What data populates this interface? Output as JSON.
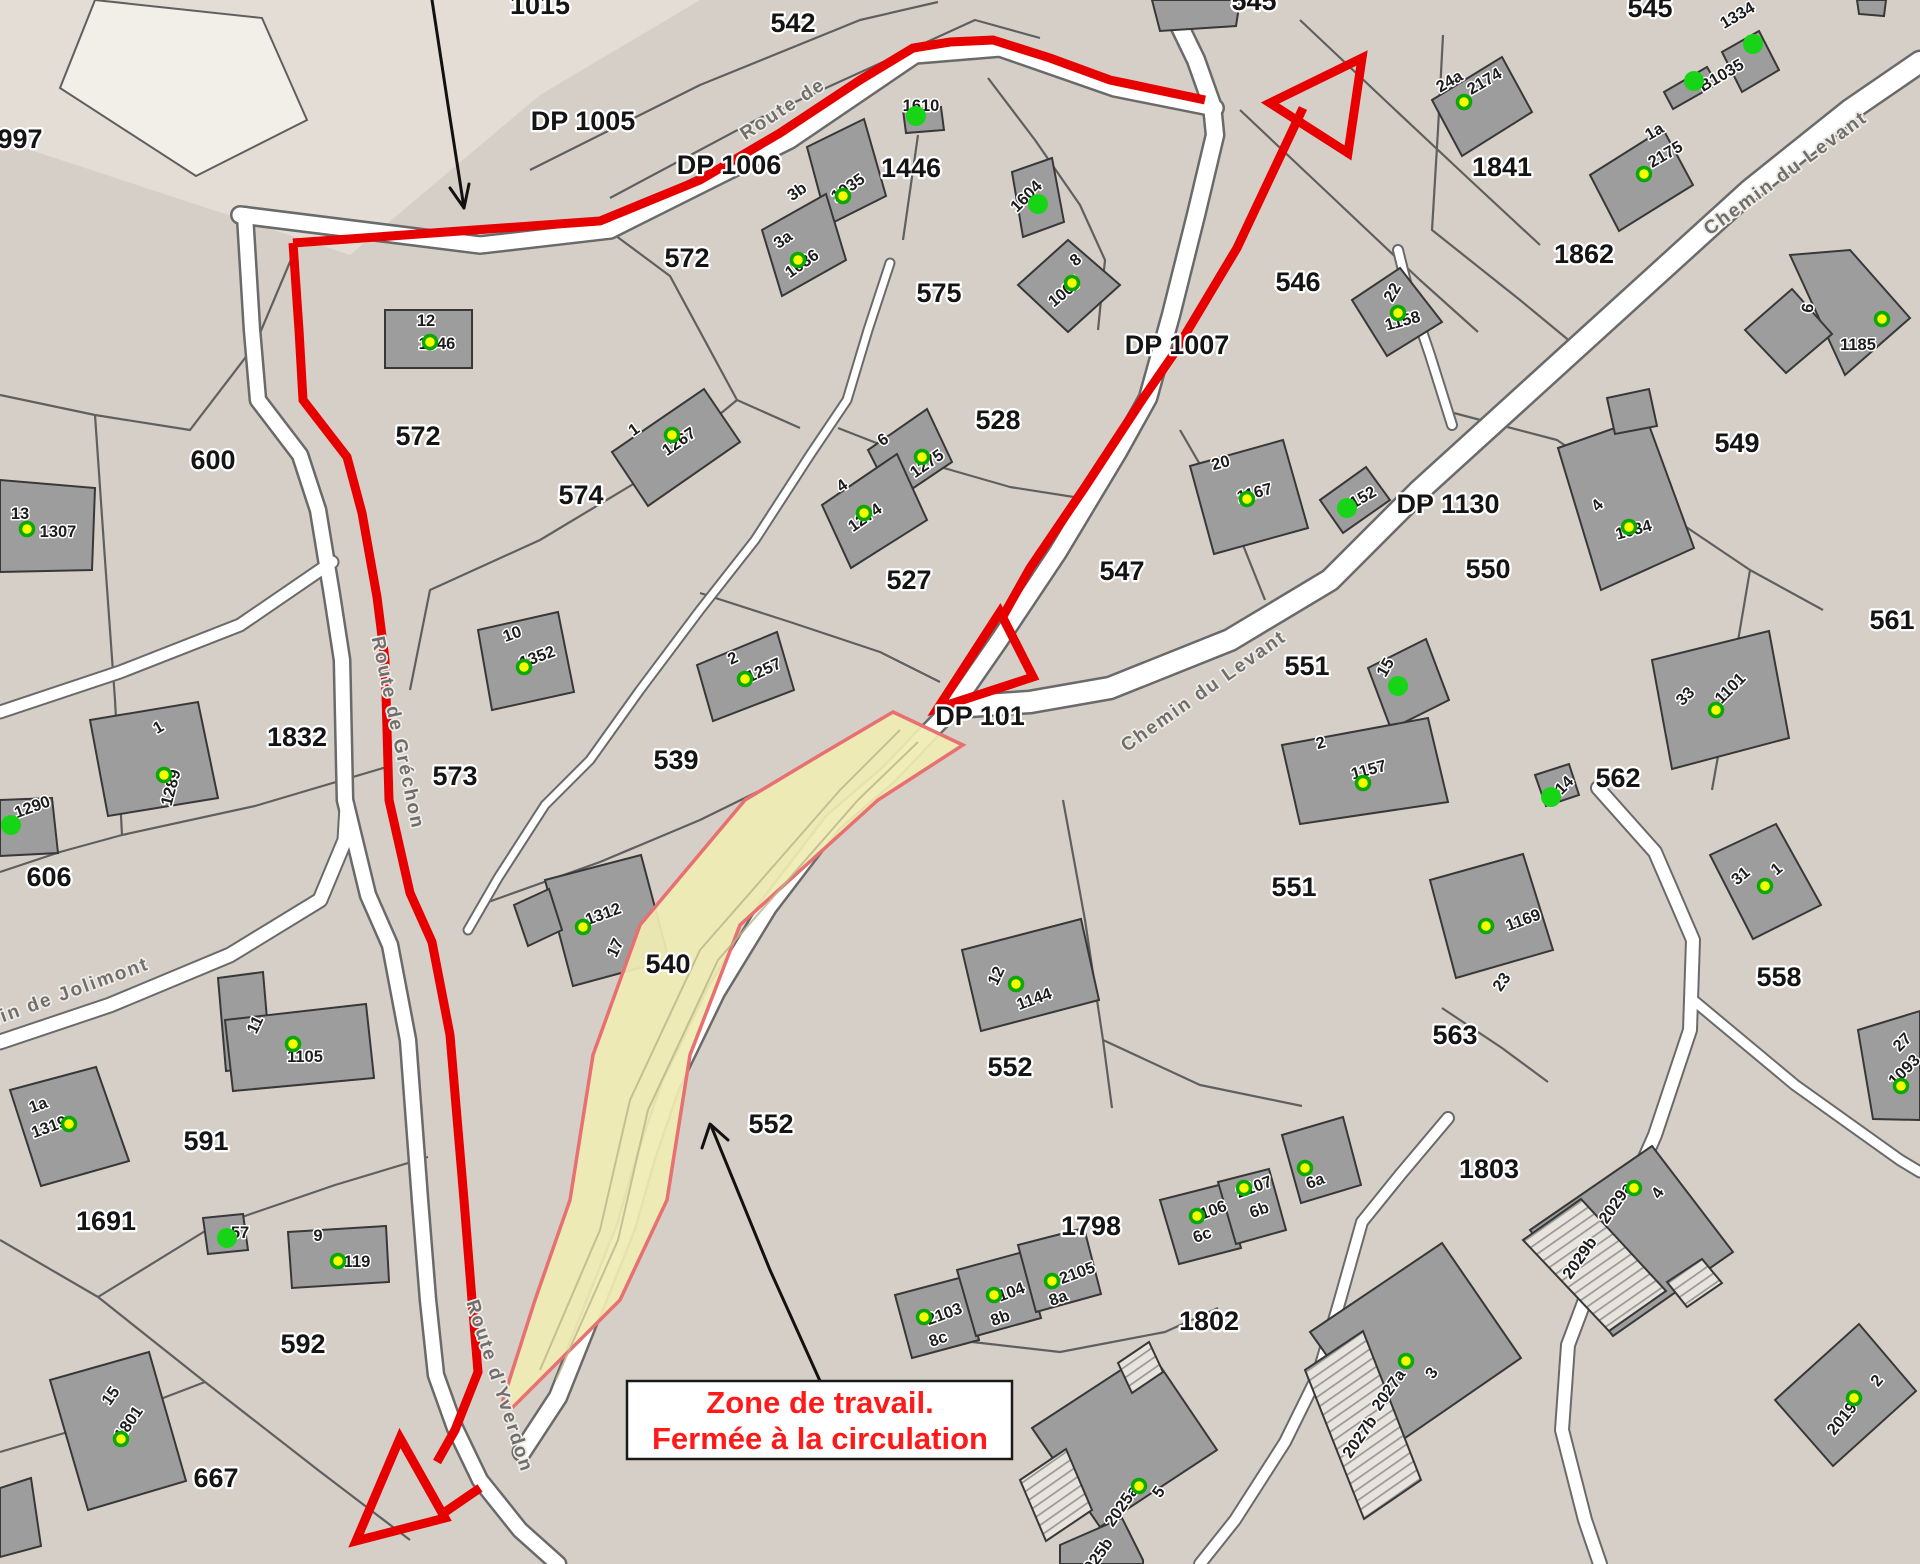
{
  "annotation": {
    "line1": "Zone de travail.",
    "line2": "Fermée à la circulation"
  },
  "colors": {
    "background": "#d6cfc7",
    "building": "#9d9d9d",
    "road": "#ffffff",
    "route_red": "#e60000",
    "zone_fill": "#f0ecb4",
    "zone_border": "#e87070",
    "dot_yellow": "#f6ff00",
    "dot_green": "#17d417",
    "annotation_text": "#ff1a1a"
  },
  "map": {
    "parcel_labels": [
      {
        "t": "997",
        "x": 20,
        "y": 148
      },
      {
        "t": "1015",
        "x": 540,
        "y": 14
      },
      {
        "t": "542",
        "x": 793,
        "y": 32
      },
      {
        "t": "545",
        "x": 1254,
        "y": 10
      },
      {
        "t": "545",
        "x": 1650,
        "y": 17
      },
      {
        "t": "DP 1005",
        "x": 583,
        "y": 130
      },
      {
        "t": "DP 1006",
        "x": 729,
        "y": 174
      },
      {
        "t": "1446",
        "x": 911,
        "y": 177
      },
      {
        "t": "572",
        "x": 687,
        "y": 267
      },
      {
        "t": "575",
        "x": 939,
        "y": 302
      },
      {
        "t": "546",
        "x": 1298,
        "y": 291
      },
      {
        "t": "1841",
        "x": 1502,
        "y": 176
      },
      {
        "t": "1862",
        "x": 1584,
        "y": 263
      },
      {
        "t": "572",
        "x": 418,
        "y": 445
      },
      {
        "t": "600",
        "x": 213,
        "y": 469
      },
      {
        "t": "574",
        "x": 581,
        "y": 504
      },
      {
        "t": "528",
        "x": 998,
        "y": 429
      },
      {
        "t": "DP 1007",
        "x": 1177,
        "y": 354
      },
      {
        "t": "527",
        "x": 909,
        "y": 589
      },
      {
        "t": "547",
        "x": 1122,
        "y": 580
      },
      {
        "t": "DP 1130",
        "x": 1448,
        "y": 513
      },
      {
        "t": "550",
        "x": 1488,
        "y": 578
      },
      {
        "t": "549",
        "x": 1737,
        "y": 452
      },
      {
        "t": "561",
        "x": 1892,
        "y": 629
      },
      {
        "t": "551",
        "x": 1307,
        "y": 675
      },
      {
        "t": "DP 101",
        "x": 980,
        "y": 725
      },
      {
        "t": "562",
        "x": 1618,
        "y": 787
      },
      {
        "t": "551",
        "x": 1294,
        "y": 896
      },
      {
        "t": "558",
        "x": 1779,
        "y": 986
      },
      {
        "t": "563",
        "x": 1455,
        "y": 1044
      },
      {
        "t": "539",
        "x": 676,
        "y": 769
      },
      {
        "t": "573",
        "x": 455,
        "y": 785
      },
      {
        "t": "1832",
        "x": 297,
        "y": 746
      },
      {
        "t": "606",
        "x": 49,
        "y": 886
      },
      {
        "t": "540",
        "x": 668,
        "y": 973
      },
      {
        "t": "591",
        "x": 206,
        "y": 1150
      },
      {
        "t": "552",
        "x": 771,
        "y": 1133
      },
      {
        "t": "552",
        "x": 1010,
        "y": 1076
      },
      {
        "t": "1691",
        "x": 106,
        "y": 1230
      },
      {
        "t": "592",
        "x": 303,
        "y": 1353
      },
      {
        "t": "667",
        "x": 216,
        "y": 1487
      },
      {
        "t": "1798",
        "x": 1091,
        "y": 1235
      },
      {
        "t": "1802",
        "x": 1209,
        "y": 1330
      },
      {
        "t": "1803",
        "x": 1489,
        "y": 1178
      }
    ],
    "building_labels": [
      {
        "t": "12",
        "x": 426,
        "y": 326
      },
      {
        "t": "1346",
        "x": 437,
        "y": 349
      },
      {
        "t": "1610",
        "x": 921,
        "y": 111
      },
      {
        "t": "3b",
        "x": 800,
        "y": 196,
        "r": -35
      },
      {
        "t": "1035",
        "x": 851,
        "y": 192,
        "r": -35
      },
      {
        "t": "3a",
        "x": 786,
        "y": 244,
        "r": -35
      },
      {
        "t": "1036",
        "x": 805,
        "y": 268,
        "r": -35
      },
      {
        "t": "1604",
        "x": 1030,
        "y": 200,
        "r": -45
      },
      {
        "t": "8",
        "x": 1079,
        "y": 264,
        "r": -40
      },
      {
        "t": "1007",
        "x": 1068,
        "y": 296,
        "r": -40
      },
      {
        "t": "22",
        "x": 1397,
        "y": 295,
        "r": -60
      },
      {
        "t": "1158",
        "x": 1404,
        "y": 326,
        "r": -15
      },
      {
        "t": "24a",
        "x": 1452,
        "y": 86,
        "r": -30
      },
      {
        "t": "2174",
        "x": 1487,
        "y": 86,
        "r": -30
      },
      {
        "t": "1334",
        "x": 1740,
        "y": 20,
        "r": -30
      },
      {
        "t": "B1035",
        "x": 1724,
        "y": 80,
        "r": -30
      },
      {
        "t": "1a",
        "x": 1657,
        "y": 136,
        "r": -30
      },
      {
        "t": "2175",
        "x": 1668,
        "y": 159,
        "r": -30
      },
      {
        "t": "6",
        "x": 1813,
        "y": 309,
        "r": -80
      },
      {
        "t": "1185",
        "x": 1858,
        "y": 350
      },
      {
        "t": "13",
        "x": 20,
        "y": 519
      },
      {
        "t": "1307",
        "x": 58,
        "y": 537
      },
      {
        "t": "1",
        "x": 161,
        "y": 732,
        "r": -30
      },
      {
        "t": "1289",
        "x": 176,
        "y": 789,
        "r": -75
      },
      {
        "t": "1290",
        "x": 34,
        "y": 812,
        "r": -20
      },
      {
        "t": "1",
        "x": 637,
        "y": 434,
        "r": -35
      },
      {
        "t": "1267",
        "x": 682,
        "y": 446,
        "r": -35
      },
      {
        "t": "6",
        "x": 886,
        "y": 444,
        "r": -35
      },
      {
        "t": "1275",
        "x": 930,
        "y": 468,
        "r": -35
      },
      {
        "t": "4",
        "x": 845,
        "y": 490,
        "r": -35
      },
      {
        "t": "1274",
        "x": 868,
        "y": 522,
        "r": -35
      },
      {
        "t": "2",
        "x": 735,
        "y": 663,
        "r": -25
      },
      {
        "t": "1257",
        "x": 766,
        "y": 675,
        "r": -25
      },
      {
        "t": "10",
        "x": 514,
        "y": 639,
        "r": -20
      },
      {
        "t": "1352",
        "x": 539,
        "y": 662,
        "r": -20
      },
      {
        "t": "20",
        "x": 1222,
        "y": 468,
        "r": -15
      },
      {
        "t": "1167",
        "x": 1256,
        "y": 498,
        "r": -15
      },
      {
        "t": "1152",
        "x": 1362,
        "y": 504,
        "r": -30
      },
      {
        "t": "15",
        "x": 1390,
        "y": 670,
        "r": -60
      },
      {
        "t": "2",
        "x": 1322,
        "y": 748,
        "r": -15
      },
      {
        "t": "1157",
        "x": 1370,
        "y": 775,
        "r": -15
      },
      {
        "t": "4",
        "x": 1601,
        "y": 509,
        "r": -45
      },
      {
        "t": "1034",
        "x": 1635,
        "y": 535,
        "r": -15
      },
      {
        "t": "33",
        "x": 1689,
        "y": 700,
        "r": -45
      },
      {
        "t": "1101",
        "x": 1734,
        "y": 692,
        "r": -45
      },
      {
        "t": "14",
        "x": 1568,
        "y": 789,
        "r": -45
      },
      {
        "t": "31",
        "x": 1744,
        "y": 880,
        "r": -40
      },
      {
        "t": "1",
        "x": 1780,
        "y": 873,
        "r": -40
      },
      {
        "t": "1169",
        "x": 1525,
        "y": 925,
        "r": -20
      },
      {
        "t": "23",
        "x": 1506,
        "y": 985,
        "r": -55
      },
      {
        "t": "27",
        "x": 1906,
        "y": 1046,
        "r": -45
      },
      {
        "t": "1093",
        "x": 1908,
        "y": 1074,
        "r": -45
      },
      {
        "t": "11",
        "x": 260,
        "y": 1027,
        "r": -65
      },
      {
        "t": "1105",
        "x": 305,
        "y": 1062
      },
      {
        "t": "1a",
        "x": 40,
        "y": 1110,
        "r": -20
      },
      {
        "t": "1319",
        "x": 51,
        "y": 1132,
        "r": -20
      },
      {
        "t": "57",
        "x": 240,
        "y": 1238
      },
      {
        "t": "9",
        "x": 318,
        "y": 1241
      },
      {
        "t": "119",
        "x": 357,
        "y": 1267
      },
      {
        "t": "15",
        "x": 115,
        "y": 1399,
        "r": -55
      },
      {
        "t": "1801",
        "x": 133,
        "y": 1426,
        "r": -55
      },
      {
        "t": "1312",
        "x": 605,
        "y": 919,
        "r": -20
      },
      {
        "t": "17",
        "x": 620,
        "y": 950,
        "r": -65
      },
      {
        "t": "12",
        "x": 1001,
        "y": 978,
        "r": -65
      },
      {
        "t": "1144",
        "x": 1036,
        "y": 1004,
        "r": -20
      },
      {
        "t": "2103",
        "x": 946,
        "y": 1319,
        "r": -20
      },
      {
        "t": "8c",
        "x": 940,
        "y": 1344,
        "r": -20
      },
      {
        "t": "104",
        "x": 1013,
        "y": 1297,
        "r": -20
      },
      {
        "t": "8b",
        "x": 1002,
        "y": 1323,
        "r": -20
      },
      {
        "t": "2105",
        "x": 1079,
        "y": 1278,
        "r": -20
      },
      {
        "t": "8a",
        "x": 1060,
        "y": 1303,
        "r": -20
      },
      {
        "t": "106",
        "x": 1215,
        "y": 1215,
        "r": -20
      },
      {
        "t": "6c",
        "x": 1204,
        "y": 1240,
        "r": -20
      },
      {
        "t": "2107",
        "x": 1256,
        "y": 1192,
        "r": -20
      },
      {
        "t": "6b",
        "x": 1261,
        "y": 1215,
        "r": -20
      },
      {
        "t": "6a",
        "x": 1317,
        "y": 1186,
        "r": -20
      },
      {
        "t": "2027a",
        "x": 1393,
        "y": 1393,
        "r": -55
      },
      {
        "t": "3",
        "x": 1436,
        "y": 1376,
        "r": -55
      },
      {
        "t": "2027b",
        "x": 1364,
        "y": 1440,
        "r": -55
      },
      {
        "t": "2025a",
        "x": 1126,
        "y": 1509,
        "r": -55
      },
      {
        "t": "5",
        "x": 1163,
        "y": 1495,
        "r": -55
      },
      {
        "t": "2025b",
        "x": 1100,
        "y": 1562,
        "r": -55
      },
      {
        "t": "2029a",
        "x": 1620,
        "y": 1206,
        "r": -55
      },
      {
        "t": "4",
        "x": 1662,
        "y": 1196,
        "r": -55
      },
      {
        "t": "2029b",
        "x": 1584,
        "y": 1261,
        "r": -55
      },
      {
        "t": "2",
        "x": 1881,
        "y": 1384,
        "r": -50
      },
      {
        "t": "2019",
        "x": 1846,
        "y": 1422,
        "r": -50
      }
    ],
    "street_labels": [
      {
        "t": "Chemin du Levant",
        "x": 1789,
        "y": 178,
        "r": -36
      },
      {
        "t": "Chemin du Levant",
        "x": 1207,
        "y": 696,
        "r": -35
      },
      {
        "t": "Chemin de Jolimont",
        "x": 48,
        "y": 1006,
        "r": -20
      },
      {
        "t": "Route de Gréchon",
        "x": 392,
        "y": 734,
        "r": 78
      },
      {
        "t": "Route d'Yverdon",
        "x": 494,
        "y": 1388,
        "r": 72
      },
      {
        "t": "Route de",
        "x": 786,
        "y": 114,
        "r": -33
      }
    ],
    "dots": [
      {
        "x": 430,
        "y": 342,
        "k": "y"
      },
      {
        "x": 916,
        "y": 116,
        "k": "g"
      },
      {
        "x": 843,
        "y": 196,
        "k": "y"
      },
      {
        "x": 798,
        "y": 260,
        "k": "y"
      },
      {
        "x": 1038,
        "y": 204,
        "k": "g"
      },
      {
        "x": 1072,
        "y": 283,
        "k": "y"
      },
      {
        "x": 1398,
        "y": 313,
        "k": "y"
      },
      {
        "x": 1464,
        "y": 102,
        "k": "y"
      },
      {
        "x": 1753,
        "y": 44,
        "k": "g"
      },
      {
        "x": 1694,
        "y": 81,
        "k": "g"
      },
      {
        "x": 1644,
        "y": 174,
        "k": "y"
      },
      {
        "x": 1882,
        "y": 319,
        "k": "y"
      },
      {
        "x": 27,
        "y": 529,
        "k": "y"
      },
      {
        "x": 164,
        "y": 775,
        "k": "y"
      },
      {
        "x": 11,
        "y": 825,
        "k": "g"
      },
      {
        "x": 672,
        "y": 435,
        "k": "y"
      },
      {
        "x": 922,
        "y": 457,
        "k": "y"
      },
      {
        "x": 864,
        "y": 513,
        "k": "y"
      },
      {
        "x": 745,
        "y": 679,
        "k": "y"
      },
      {
        "x": 524,
        "y": 667,
        "k": "y"
      },
      {
        "x": 1247,
        "y": 499,
        "k": "y"
      },
      {
        "x": 1347,
        "y": 508,
        "k": "g"
      },
      {
        "x": 1398,
        "y": 686,
        "k": "g"
      },
      {
        "x": 1363,
        "y": 783,
        "k": "y"
      },
      {
        "x": 1629,
        "y": 527,
        "k": "y"
      },
      {
        "x": 1716,
        "y": 710,
        "k": "y"
      },
      {
        "x": 1551,
        "y": 797,
        "k": "g"
      },
      {
        "x": 1765,
        "y": 886,
        "k": "y"
      },
      {
        "x": 1486,
        "y": 926,
        "k": "y"
      },
      {
        "x": 1901,
        "y": 1086,
        "k": "y"
      },
      {
        "x": 293,
        "y": 1044,
        "k": "y"
      },
      {
        "x": 69,
        "y": 1124,
        "k": "y"
      },
      {
        "x": 227,
        "y": 1238,
        "k": "g"
      },
      {
        "x": 338,
        "y": 1261,
        "k": "y"
      },
      {
        "x": 121,
        "y": 1439,
        "k": "y"
      },
      {
        "x": 583,
        "y": 927,
        "k": "y"
      },
      {
        "x": 1016,
        "y": 984,
        "k": "y"
      },
      {
        "x": 924,
        "y": 1317,
        "k": "y"
      },
      {
        "x": 994,
        "y": 1295,
        "k": "y"
      },
      {
        "x": 1052,
        "y": 1281,
        "k": "y"
      },
      {
        "x": 1197,
        "y": 1216,
        "k": "y"
      },
      {
        "x": 1244,
        "y": 1188,
        "k": "y"
      },
      {
        "x": 1305,
        "y": 1168,
        "k": "y"
      },
      {
        "x": 1406,
        "y": 1361,
        "k": "y"
      },
      {
        "x": 1139,
        "y": 1486,
        "k": "y"
      },
      {
        "x": 1634,
        "y": 1188,
        "k": "y"
      },
      {
        "x": 1854,
        "y": 1398,
        "k": "y"
      }
    ]
  }
}
